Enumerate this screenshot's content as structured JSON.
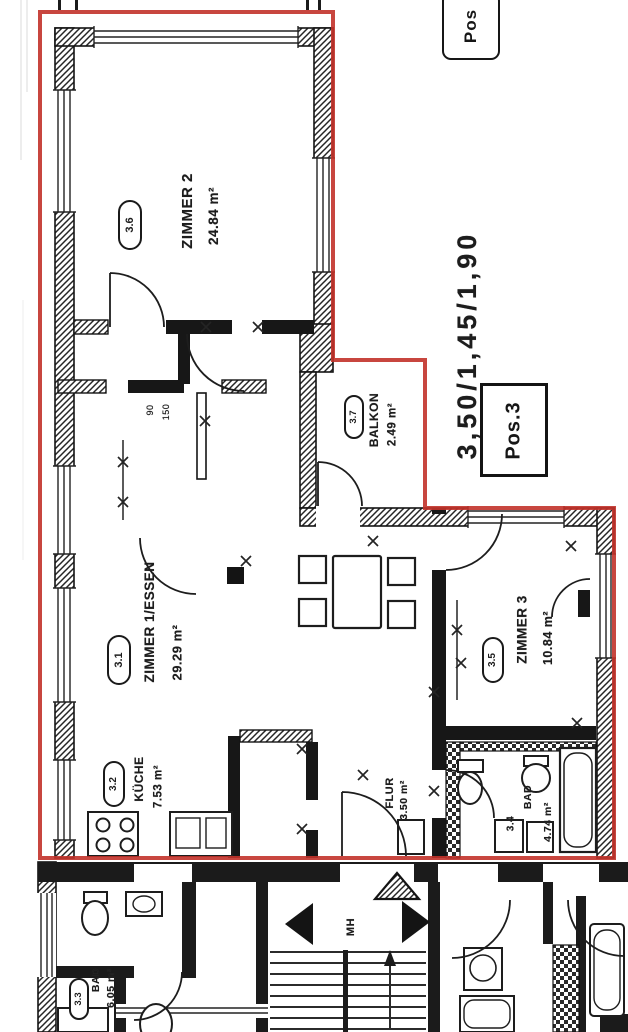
{
  "drawing": {
    "outline_color": "#c2322a",
    "ink_color": "#1a1a1a",
    "paper_color": "#ffffff"
  },
  "tags": {
    "pos_top": "Pos",
    "pos_unit": "Pos.3",
    "balcony_dims": "3,50/1,45/1,90",
    "stairwell_label": "MH",
    "door_dim_90": "90",
    "door_dim_150": "150"
  },
  "rooms": [
    {
      "key": "zimmer2",
      "badge": "3.6",
      "name": "ZIMMER 2",
      "area": "24.84 m²"
    },
    {
      "key": "balkon",
      "badge": "3.7",
      "name": "BALKON",
      "area": "2.49 m²"
    },
    {
      "key": "zimmer1_essen",
      "badge": "3.1",
      "name": "ZIMMER 1/ESSEN",
      "area": "29.29 m²"
    },
    {
      "key": "kueche",
      "badge": "3.2",
      "name": "KÜCHE",
      "area": "7.53 m²"
    },
    {
      "key": "zimmer3",
      "badge": "3.5",
      "name": "ZIMMER 3",
      "area": "10.84 m²"
    },
    {
      "key": "flur",
      "badge": "",
      "name": "FLUR",
      "area": "3.50 m²"
    },
    {
      "key": "bad",
      "badge": "3.4",
      "name": "BAD",
      "area": "4.74 m²"
    },
    {
      "key": "bad_nachbar",
      "badge": "3.3",
      "name": "BAD",
      "area": "6.05 m²"
    }
  ]
}
